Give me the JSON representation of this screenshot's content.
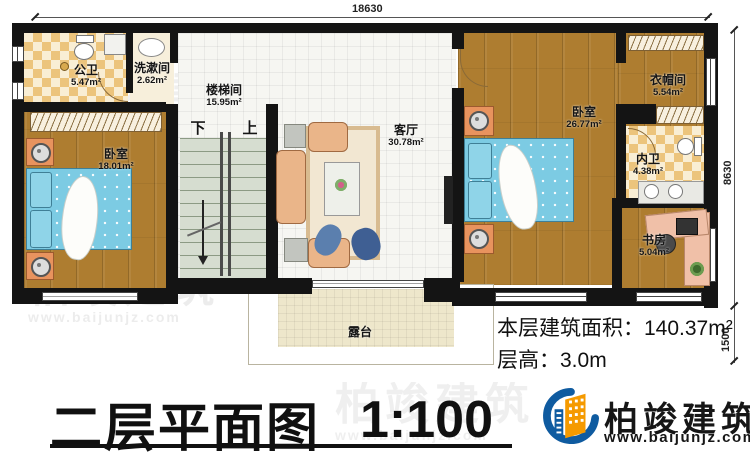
{
  "title": {
    "text": "二层平面图",
    "scale": "1:100"
  },
  "floor_info": {
    "area_label": "本层建筑面积：",
    "area_value": "140.37m²",
    "height_label": "层高：",
    "height_value": "3.0m"
  },
  "dimensions": {
    "top": "18630",
    "right_upper": "8630",
    "right_lower": "1500"
  },
  "stairs": {
    "down": "下",
    "up": "上"
  },
  "plan": {
    "rooms": [
      {
        "name": "公卫",
        "area": "5.47m²"
      },
      {
        "name": "洗漱间",
        "area": "2.62m²"
      },
      {
        "name": "楼梯间",
        "area": "15.95m²"
      },
      {
        "name": "卧室",
        "area": "18.01m²"
      },
      {
        "name": "客厅",
        "area": "30.78m²"
      },
      {
        "name": "卧室",
        "area": "26.77m²"
      },
      {
        "name": "衣帽间",
        "area": "5.54m²"
      },
      {
        "name": "内卫",
        "area": "4.38m²"
      },
      {
        "name": "书房",
        "area": "5.04m²"
      },
      {
        "name": "露台",
        "area": ""
      }
    ]
  },
  "brand": {
    "name": "柏竣建筑",
    "website": "www.baijunjz.com"
  },
  "colors": {
    "wall": "#141414",
    "wood": "#ae7d30",
    "bed": "#7ccbe3",
    "logo_blue": "#0f5ba0",
    "logo_orange": "#f59a00"
  }
}
